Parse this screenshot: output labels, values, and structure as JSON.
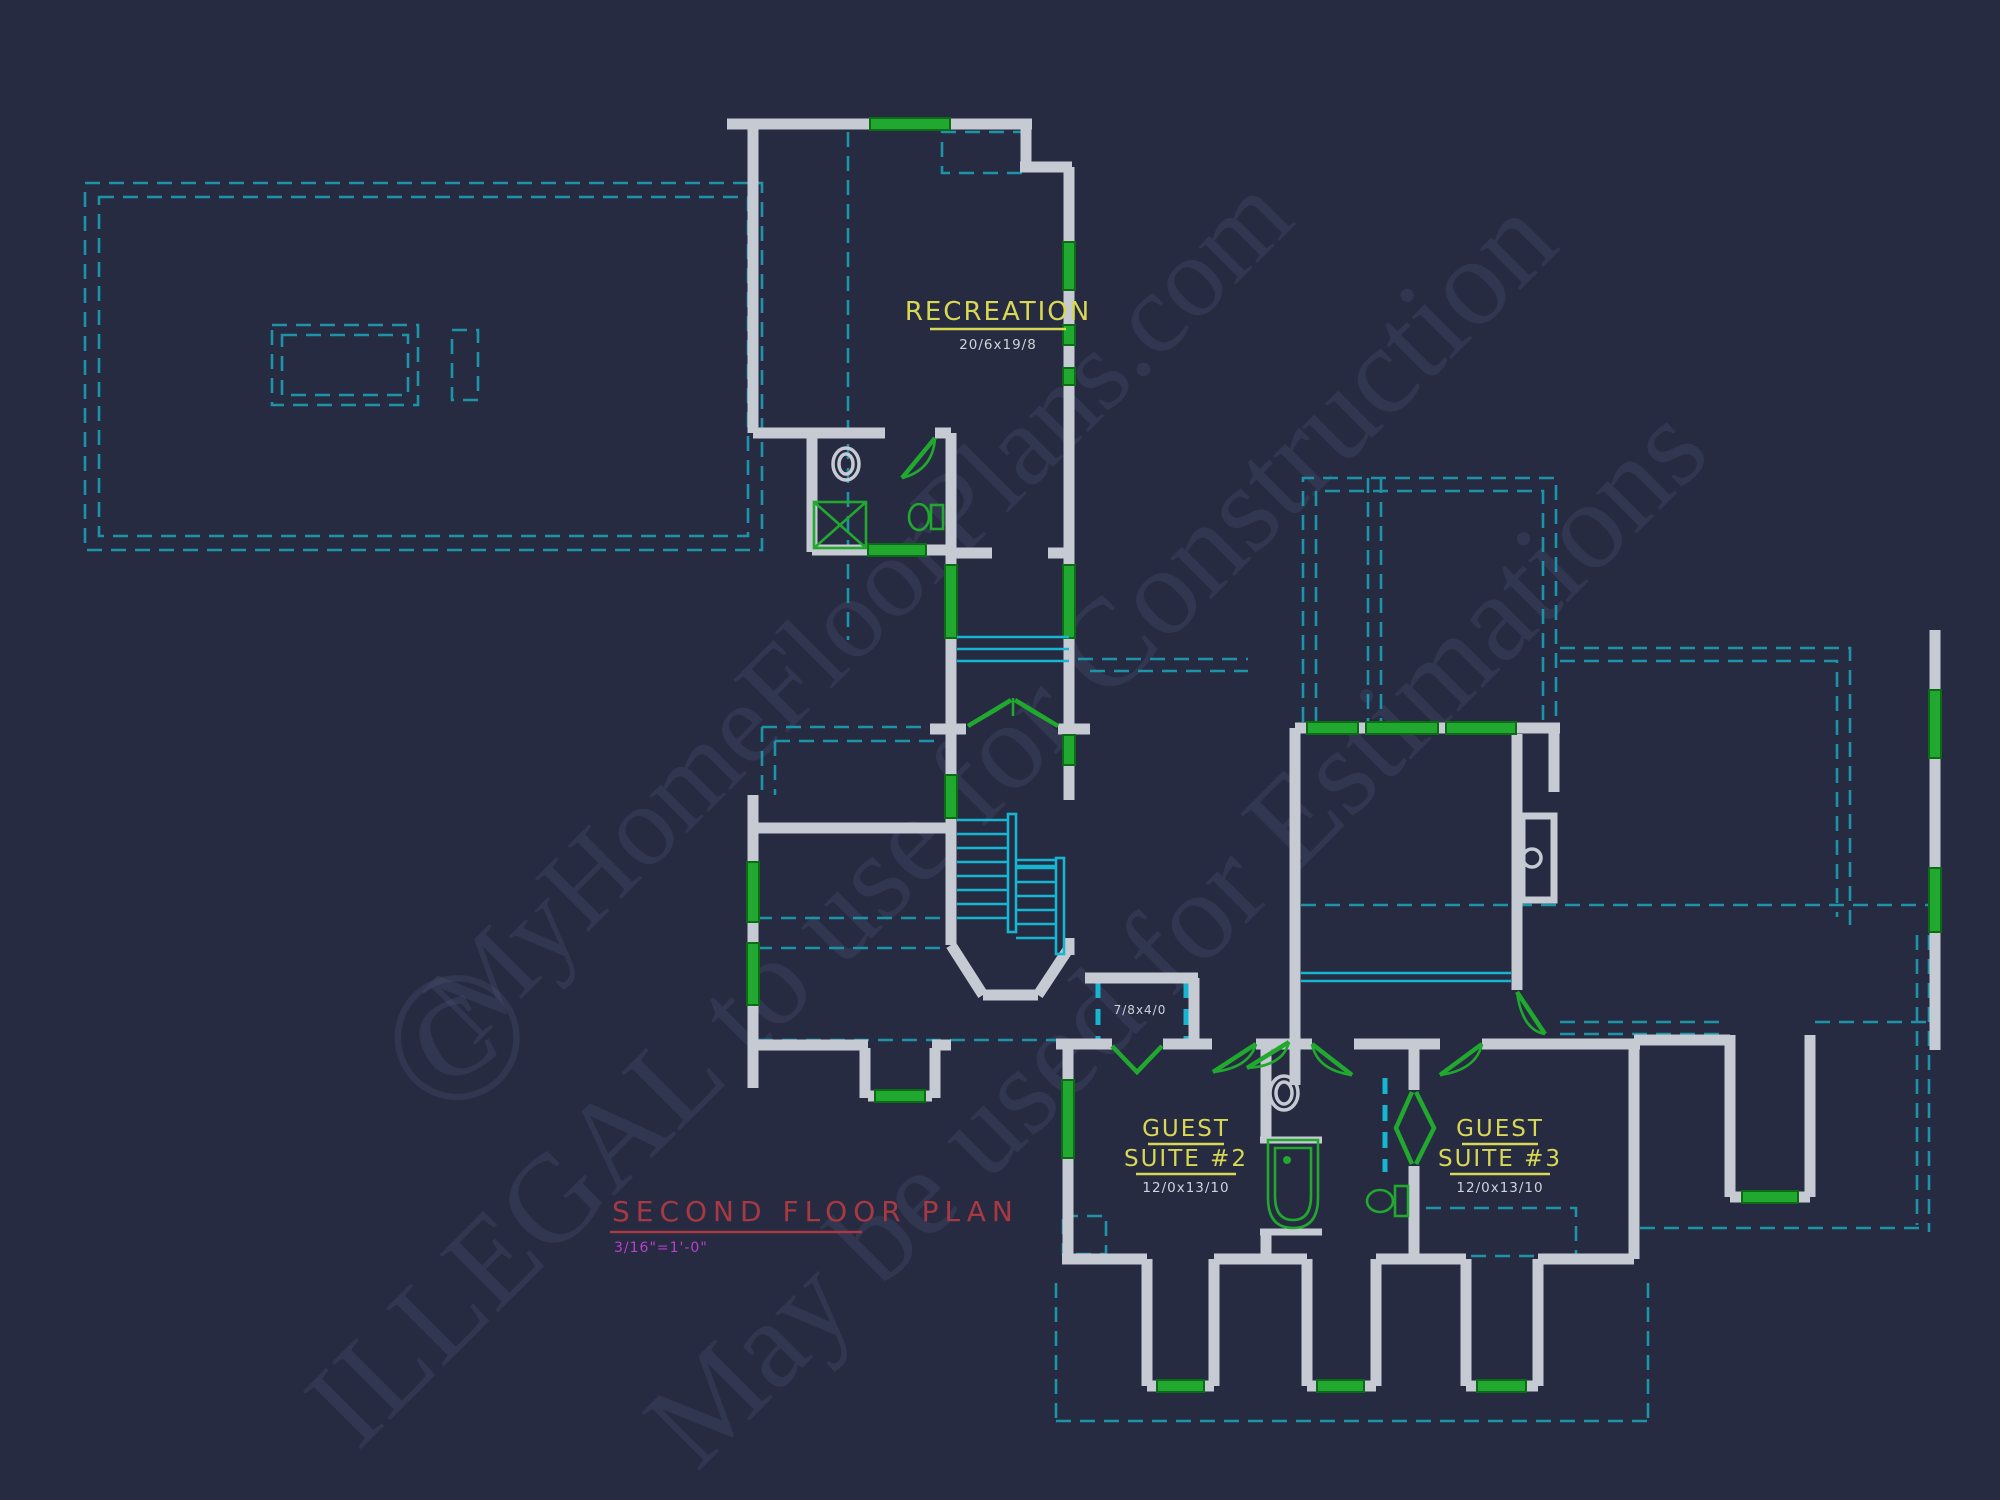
{
  "plan_title": {
    "text": "SECOND FLOOR PLAN",
    "scale": "3/16\"=1'-0\"",
    "title_color": "#a83842",
    "scale_color": "#bb3fd0"
  },
  "rooms": {
    "recreation": {
      "name": "RECREATION",
      "dims": "20/6x19/8"
    },
    "guest_suite_2": {
      "name_line1": "GUEST",
      "name_line2": "SUITE #2",
      "dims": "12/0x13/10"
    },
    "guest_suite_3": {
      "name_line1": "GUEST",
      "name_line2": "SUITE #3",
      "dims": "12/0x13/10"
    },
    "hall_closet": {
      "dims": "7/8x4/0"
    }
  },
  "watermarks": {
    "copyright_symbol": "©",
    "site": "MyHomeFloorPlans.com",
    "illegal_notice": "ILLEGAL to use for Construction",
    "estimation_notice": "May be used for Estimations"
  },
  "colors": {
    "background": "#262b41",
    "walls": "#c6cad3",
    "roof_dashed_teal": "#1d93a8",
    "stairs_cyan": "#16b6d2",
    "fixture_green": "#21a82e",
    "label_yellow": "#d8d855",
    "dimension_white": "#cfd3da",
    "title_red": "#a83842",
    "scale_magenta": "#bb3fd0",
    "watermark_gray": "#4a5270"
  }
}
